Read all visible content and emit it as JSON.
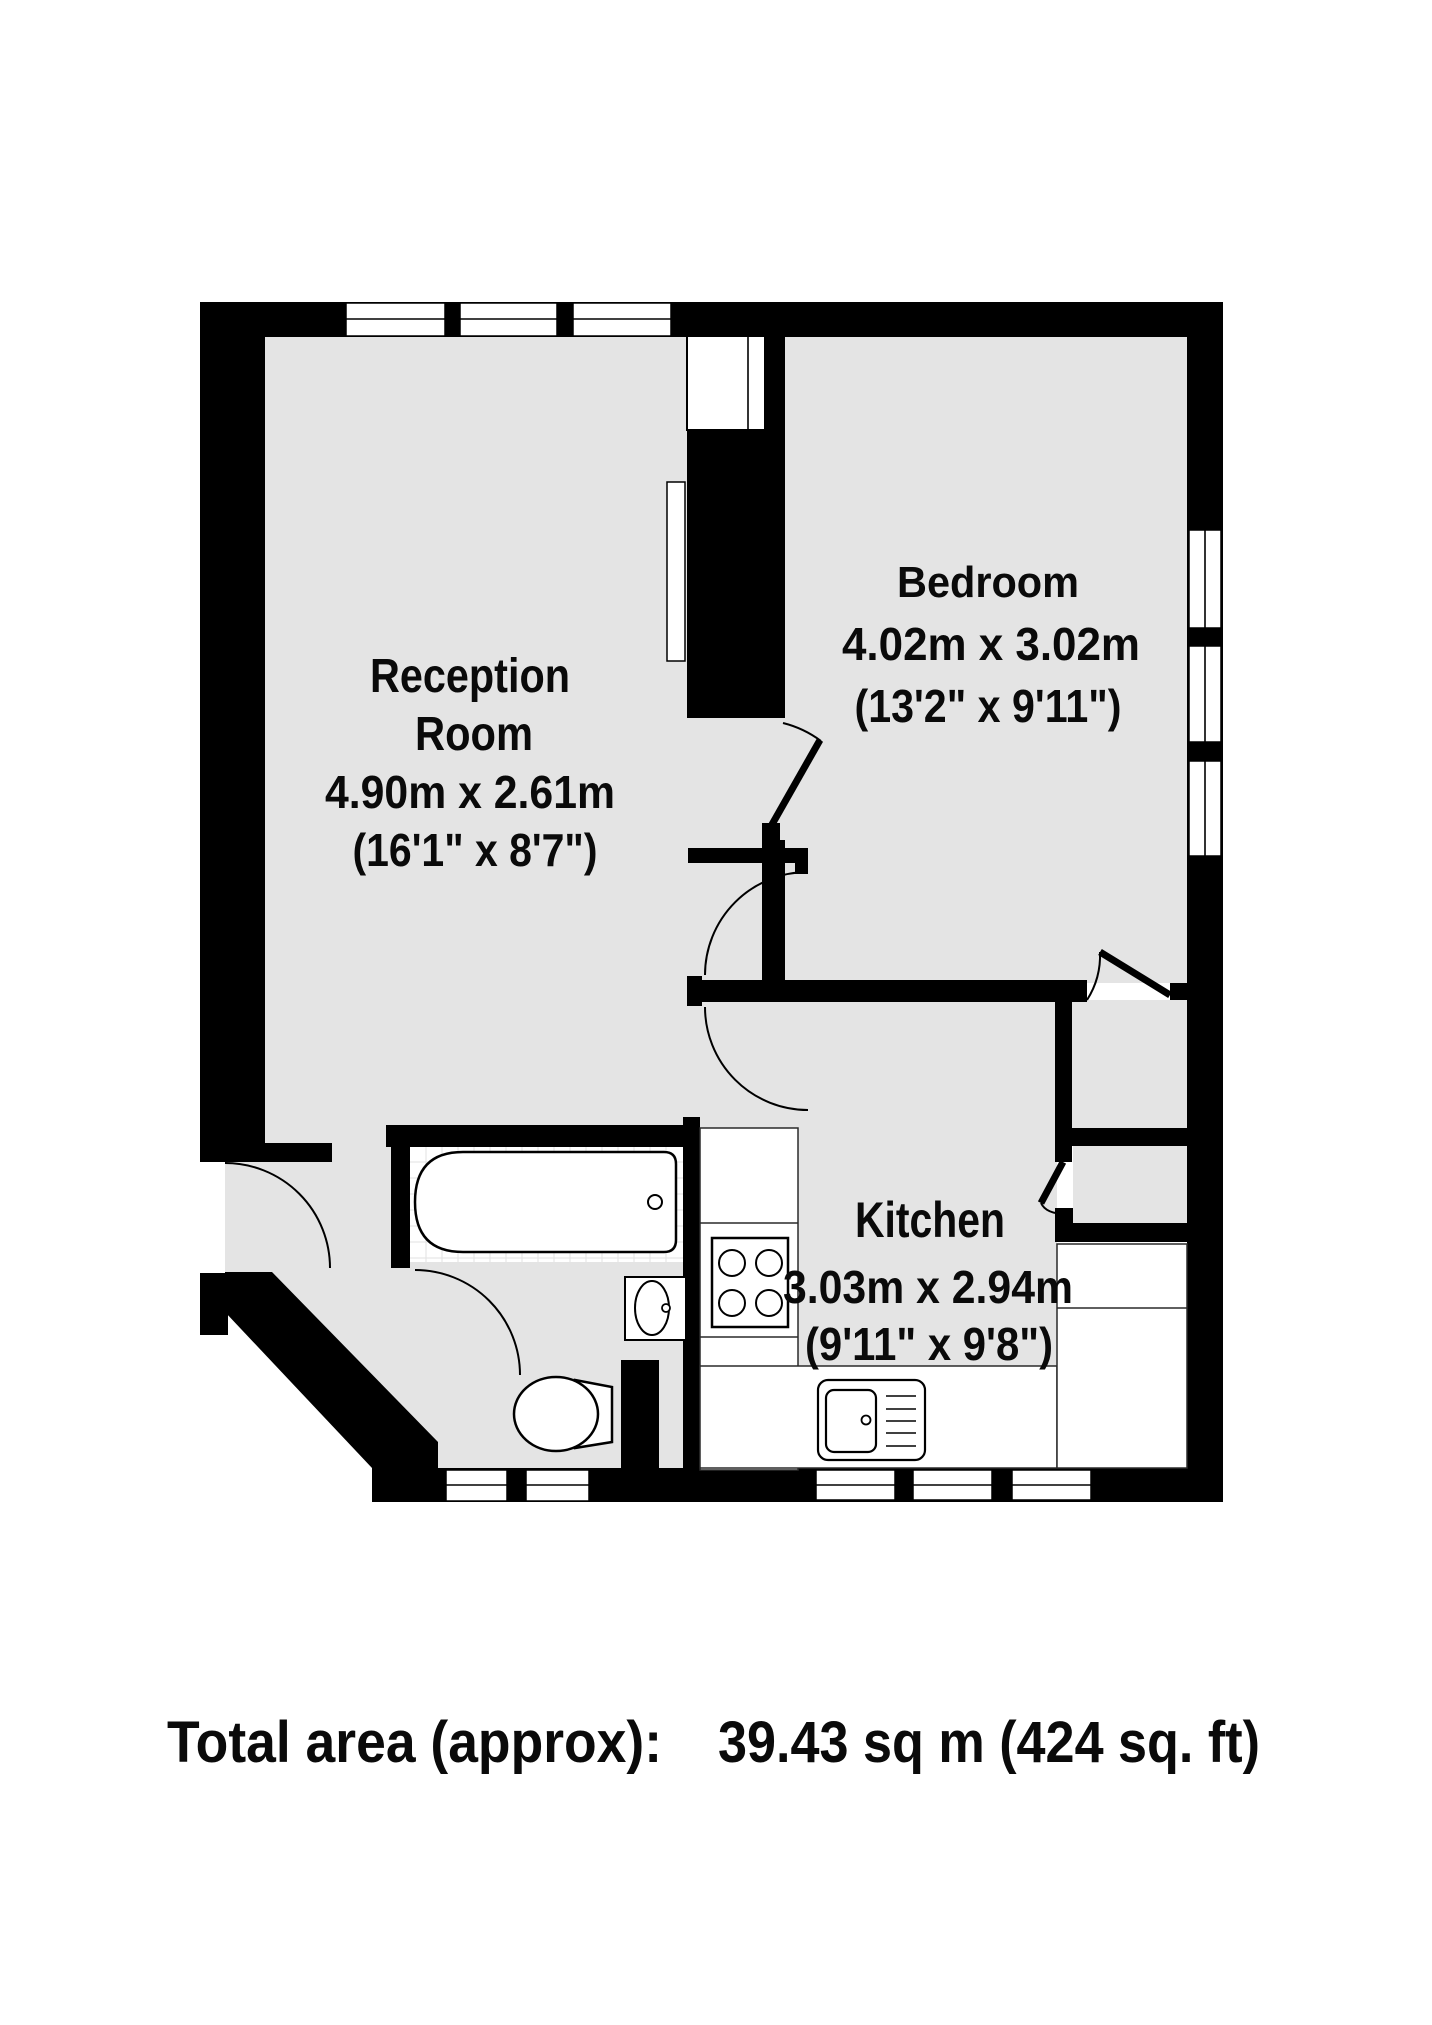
{
  "plan_title": "1 bed flat floor plan",
  "colors": {
    "floor": "#e4e4e4",
    "wall": "#000000",
    "fixture": "#ffffff",
    "tile_grid": "#e2e2e2"
  },
  "rooms": {
    "reception": {
      "name_line1": "Reception",
      "name_line2": "Room",
      "dims_metric": "4.90m x 2.61m",
      "dims_imperial": "(16'1\" x 8'7\")"
    },
    "bedroom": {
      "name": "Bedroom",
      "dims_metric": "4.02m x 3.02m",
      "dims_imperial": "(13'2\" x 9'11\")"
    },
    "kitchen": {
      "name": "Kitchen",
      "dims_metric": "3.03m x 2.94m",
      "dims_imperial": "(9'11\" x 9'8\")"
    }
  },
  "fixtures": {
    "bathtub": "bathtub",
    "basin": "wash basin",
    "toilet": "toilet",
    "hob": "4-ring hob",
    "kitchen_sink": "sink with drainer",
    "radiator": "radiator",
    "chimney": "chimney breast"
  },
  "footer": {
    "label": "Total area (approx):",
    "value": "39.43 sq m (424 sq. ft)"
  }
}
